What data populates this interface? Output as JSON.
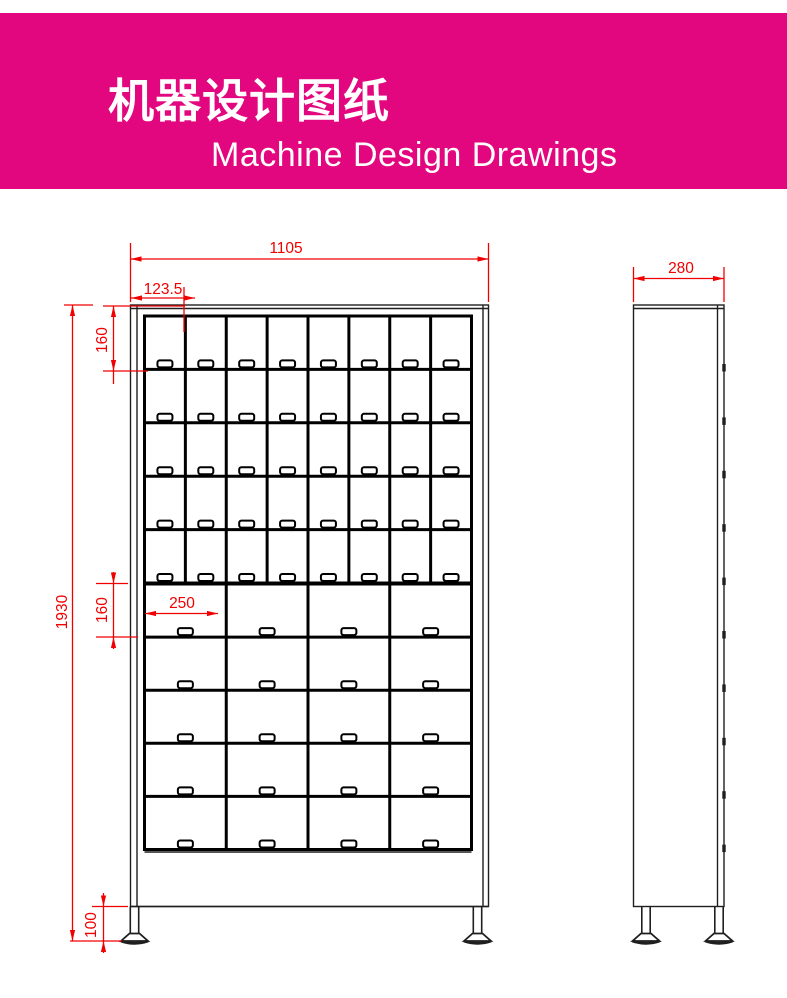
{
  "banner": {
    "title": "机器设计图纸",
    "subtitle": "Machine Design Drawings",
    "bg_color": "#e3077f",
    "text_color": "#ffffff"
  },
  "drawing": {
    "frame_color": "#1f1f1f",
    "grid_color": "#000000",
    "dim_color": "#f10000",
    "front_view": {
      "outer": [
        130.5,
        305,
        488.5,
        906.5
      ],
      "frame_vlines": [
        [
          137,
          305,
          906.5
        ],
        [
          483,
          305,
          906.5
        ]
      ],
      "frame_hlines": [
        [
          308.5,
          130.5,
          488.5
        ],
        [
          852,
          144.5,
          471.5
        ],
        [
          906.5,
          130.5,
          488.5
        ]
      ],
      "small_grid": {
        "x": 144.5,
        "y": 316,
        "w": 327,
        "h": 267,
        "rows": 5,
        "cols": 8
      },
      "big_grid": {
        "x": 144.5,
        "y": 584,
        "w": 327,
        "h": 265.5,
        "rows": 5,
        "cols": 4
      },
      "handle": {
        "w": 15,
        "h": 7,
        "rx": 2.2,
        "lift": 9
      },
      "feet_cx": [
        134.5,
        477.5
      ],
      "foot": {
        "top": 906.5,
        "stem_half": 4.2,
        "stem_bottom": 933.5,
        "neck_half": 5,
        "base_half": 13.5,
        "base_bottom": 941,
        "curve_drop": 4.5
      }
    },
    "side_view": {
      "outer": [
        633.5,
        305,
        724,
        906.5
      ],
      "top_hline_y": 308.5,
      "door_line_x": 717.5,
      "hinges": {
        "x": 722.3,
        "w": 3.4,
        "h": 7.5,
        "ys": [
          364,
          417.4,
          470.8,
          524.2,
          577.6,
          631,
          684.4,
          737.8,
          791.2,
          844.6
        ]
      },
      "feet_cx": [
        646,
        719
      ]
    },
    "dimensions": [
      {
        "id": "overall-width",
        "label": "1105",
        "line": [
          130.5,
          259,
          488.5,
          259
        ],
        "arrows": [
          [
            130.5,
            259,
            "left"
          ],
          [
            488.5,
            259,
            "right"
          ]
        ],
        "exts": [
          [
            130.5,
            243,
            130.5,
            302
          ],
          [
            488.5,
            243,
            488.5,
            302
          ]
        ],
        "text": {
          "x": 286,
          "y": 253,
          "rot": 0
        }
      },
      {
        "id": "top-cell-width",
        "label": "123.5",
        "line": [
          131,
          298,
          195,
          298
        ],
        "arrows": [
          [
            131,
            298,
            "left"
          ],
          [
            195,
            298,
            "right"
          ]
        ],
        "exts": [
          [
            184,
            287,
            184,
            332
          ]
        ],
        "text": {
          "x": 163,
          "y": 294,
          "rot": 0
        }
      },
      {
        "id": "small-row-height",
        "label": "160",
        "line": [
          113.5,
          306,
          113.5,
          384
        ],
        "arrows": [
          [
            113.5,
            306,
            "up"
          ],
          [
            113.5,
            371,
            "down"
          ]
        ],
        "exts": [
          [
            103,
            306,
            185,
            306
          ],
          [
            103,
            371,
            148,
            371
          ]
        ],
        "text": {
          "x": 107,
          "y": 340,
          "rot": -90
        }
      },
      {
        "id": "overall-height",
        "label": "1930",
        "line": [
          72.5,
          305,
          72.5,
          941
        ],
        "arrows": [
          [
            72.5,
            305,
            "up"
          ],
          [
            72.5,
            941,
            "down"
          ]
        ],
        "exts": [
          [
            64,
            305,
            93,
            305
          ]
        ],
        "text": {
          "x": 67,
          "y": 612,
          "rot": -90
        }
      },
      {
        "id": "big-cell-width",
        "label": "250",
        "line": [
          145,
          613.5,
          218,
          613.5
        ],
        "arrows": [
          [
            145,
            613.5,
            "left"
          ],
          [
            218,
            613.5,
            "right"
          ]
        ],
        "exts": [],
        "text": {
          "x": 182,
          "y": 608,
          "rot": 0
        }
      },
      {
        "id": "big-row-height",
        "label": "160",
        "line": [
          113.5,
          572,
          113.5,
          649
        ],
        "arrows": [
          [
            113.5,
            583.5,
            "down"
          ],
          [
            113.5,
            637,
            "up"
          ]
        ],
        "exts": [
          [
            96,
            583.5,
            128,
            583.5
          ],
          [
            96,
            637,
            138,
            637
          ]
        ],
        "text": {
          "x": 107,
          "y": 610,
          "rot": -90
        }
      },
      {
        "id": "foot-height",
        "label": "100",
        "line": [
          103.5,
          893,
          103.5,
          953
        ],
        "arrows": [
          [
            103.5,
            906.5,
            "down"
          ],
          [
            103.5,
            941,
            "up"
          ]
        ],
        "exts": [
          [
            92,
            906.5,
            128,
            906.5
          ],
          [
            70,
            941,
            122,
            941
          ]
        ],
        "text": {
          "x": 96,
          "y": 925,
          "rot": -90
        }
      },
      {
        "id": "depth",
        "label": "280",
        "line": [
          633.5,
          278.5,
          724,
          278.5
        ],
        "arrows": [
          [
            633.5,
            278.5,
            "left"
          ],
          [
            724,
            278.5,
            "right"
          ]
        ],
        "exts": [
          [
            633.5,
            267,
            633.5,
            302
          ],
          [
            724,
            267,
            724,
            302
          ]
        ],
        "text": {
          "x": 681,
          "y": 273,
          "rot": 0
        }
      }
    ]
  }
}
